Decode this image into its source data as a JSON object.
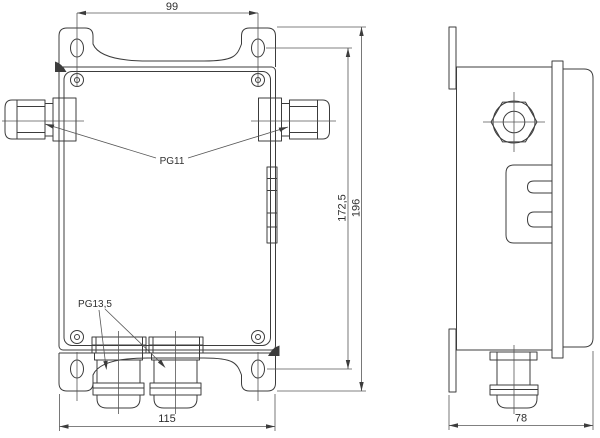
{
  "drawing": {
    "type": "technical-drawing-junction-box",
    "colors": {
      "line": "#3c3c3c",
      "dim_line": "#565656",
      "text": "#2f2f2f",
      "background": "#ffffff"
    },
    "dims": {
      "top_hole_spacing": "99",
      "base_width": "115",
      "mounting_hole_height": "172,5",
      "overall_height": "196",
      "depth": "78"
    },
    "labels": {
      "side_glands": "PG11",
      "bottom_glands": "PG13,5"
    }
  }
}
